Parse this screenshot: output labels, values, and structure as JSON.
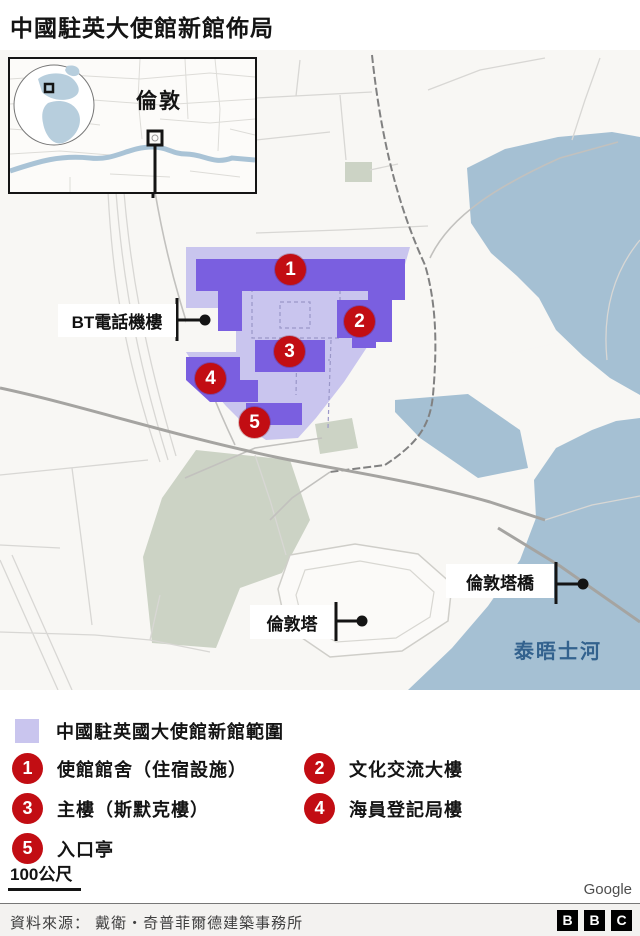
{
  "title": "中國駐英大使館新館佈局",
  "inset": {
    "city_label": "倫敦"
  },
  "map": {
    "labels": {
      "bt": "BT電話機樓",
      "tower_bridge": "倫敦塔橋",
      "tower": "倫敦塔",
      "thames": "泰晤士河"
    },
    "markers": [
      {
        "number": "1"
      },
      {
        "number": "2"
      },
      {
        "number": "3"
      },
      {
        "number": "4"
      },
      {
        "number": "5"
      }
    ],
    "attribution": "Google"
  },
  "legend": {
    "area_label": "中國駐英國大使館新館範圍",
    "items": [
      {
        "number": "1",
        "label": "使館館舍（住宿設施）"
      },
      {
        "number": "2",
        "label": "文化交流大樓"
      },
      {
        "number": "3",
        "label": "主樓（斯默克樓）"
      },
      {
        "number": "4",
        "label": "海員登記局樓"
      },
      {
        "number": "5",
        "label": "入口亭"
      }
    ]
  },
  "scale": {
    "label": "100公尺"
  },
  "footer": {
    "source": "資料來源： 戴衛・奇普菲爾德建築事務所",
    "bbc": [
      "B",
      "B",
      "C"
    ]
  },
  "colors": {
    "site_area": "#c9c5ee",
    "buildings": "#7a5fe0",
    "marker_red": "#c20d13",
    "water": "#a5c0d3",
    "park": "#ccd3c5",
    "thames_text": "#33628e"
  }
}
